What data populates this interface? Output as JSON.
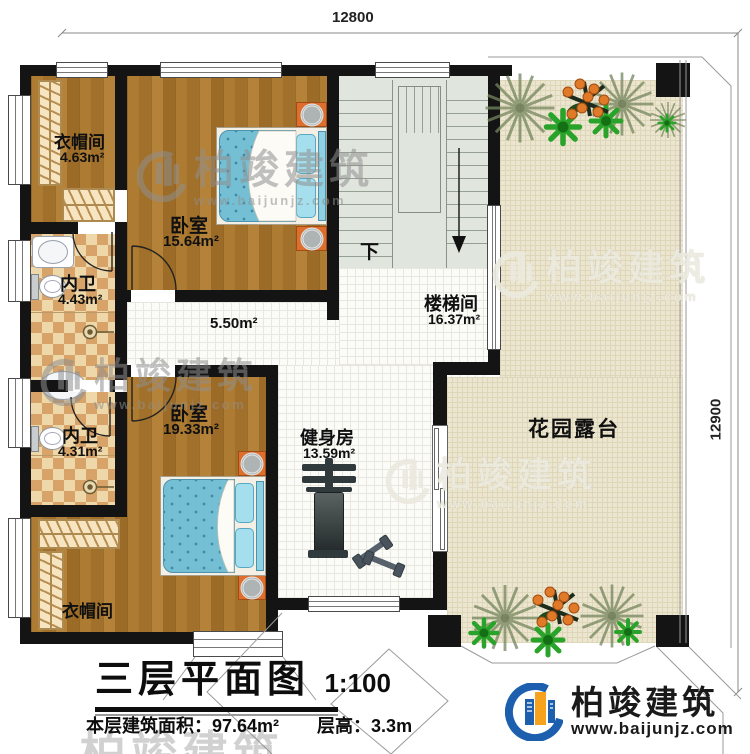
{
  "dimensions": {
    "top": "12800",
    "right": "12900"
  },
  "rooms": {
    "closet_top": {
      "name": "衣帽间",
      "area": "4.63m²"
    },
    "bedroom_top": {
      "name": "卧室",
      "area": "15.64m²"
    },
    "bath_top": {
      "name": "内卫",
      "area": "4.43m²"
    },
    "bath_bottom": {
      "name": "内卫",
      "area": "4.31m²"
    },
    "bedroom_bottom": {
      "name": "卧室",
      "area": "19.33m²"
    },
    "closet_bottom": {
      "name": "衣帽间"
    },
    "hallway": {
      "area": "5.50m²"
    },
    "stairwell": {
      "name": "楼梯间",
      "area": "16.37m²",
      "down": "下"
    },
    "gym": {
      "name": "健身房",
      "area": "13.59m²"
    },
    "terrace": {
      "name": "花园露台"
    }
  },
  "title_block": {
    "title": "三层平面图",
    "scale": "1:100",
    "floor_area": "本层建筑面积：97.64m²",
    "floor_height": "层高：3.3m"
  },
  "branding": {
    "company": "柏竣建筑",
    "website": "www.baijunjz.com"
  },
  "colors": {
    "wall": "#141414",
    "wood": "#a9772e",
    "tile": "#d7a368",
    "terrace": "#ece6d0",
    "bed": "#74bfd4",
    "logo_blue": "#1b5fae",
    "logo_orange": "#f6a21d"
  }
}
